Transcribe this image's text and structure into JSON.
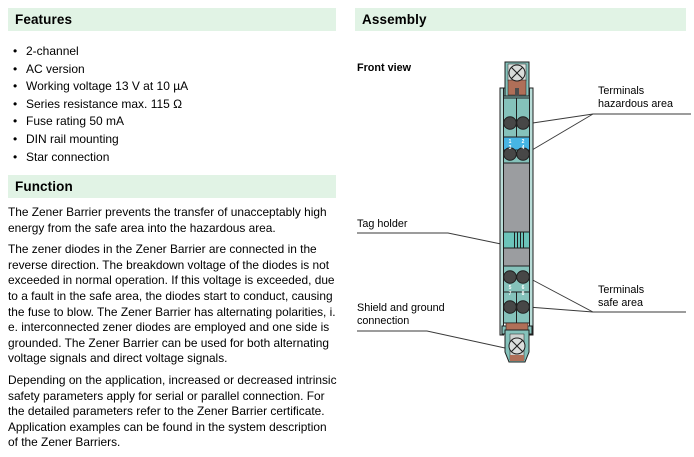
{
  "features": {
    "title": "Features",
    "items": [
      "2-channel",
      "AC version",
      "Working voltage 13 V at 10 µA",
      "Series resistance max. 115 Ω",
      "Fuse rating 50 mA",
      "DIN rail mounting",
      "Star connection"
    ]
  },
  "function": {
    "title": "Function",
    "paragraphs": [
      "The Zener Barrier prevents the transfer of unacceptably high energy from the safe area into the hazardous area.",
      "The zener diodes in the Zener Barrier are connected in the reverse direction. The breakdown voltage of the diodes is not exceeded in normal operation. If this voltage is exceeded, due to a fault in the safe area, the diodes start to conduct, causing the fuse to blow. The Zener Barrier has alternating polarities, i. e. interconnected zener diodes are employed and one side is grounded. The Zener Barrier can be used for both alternating voltage signals and direct voltage signals.",
      "Depending on the application, increased or decreased intrinsic safety parameters apply for serial or parallel connection. For the detailed parameters refer to the Zener Barrier certificate. Application examples can be found in the system description of the Zener Barriers."
    ]
  },
  "assembly": {
    "title": "Assembly",
    "front_view_label": "Front view",
    "labels": {
      "terminals_hazardous": {
        "line1": "Terminals",
        "line2": "hazardous area"
      },
      "tag_holder": "Tag holder",
      "terminals_safe": {
        "line1": "Terminals",
        "line2": "safe area"
      },
      "shield_ground": {
        "line1": "Shield and ground",
        "line2": "connection"
      }
    },
    "terminal_numbers": {
      "hazardous": [
        "1",
        "3",
        "2",
        "4"
      ],
      "safe": [
        "5",
        "7",
        "6",
        "8"
      ]
    }
  },
  "colors": {
    "section_bar_bg": "#e1f3e5",
    "device_teal": "#85c2bb",
    "device_rail_teal": "#b9ddd8",
    "device_gray": "#9b9da0",
    "device_copper": "#b06f58",
    "terminal_strip_blue": "#47b5e4",
    "terminal_dark": "#474747",
    "leader_line": "#3a3a3a"
  }
}
